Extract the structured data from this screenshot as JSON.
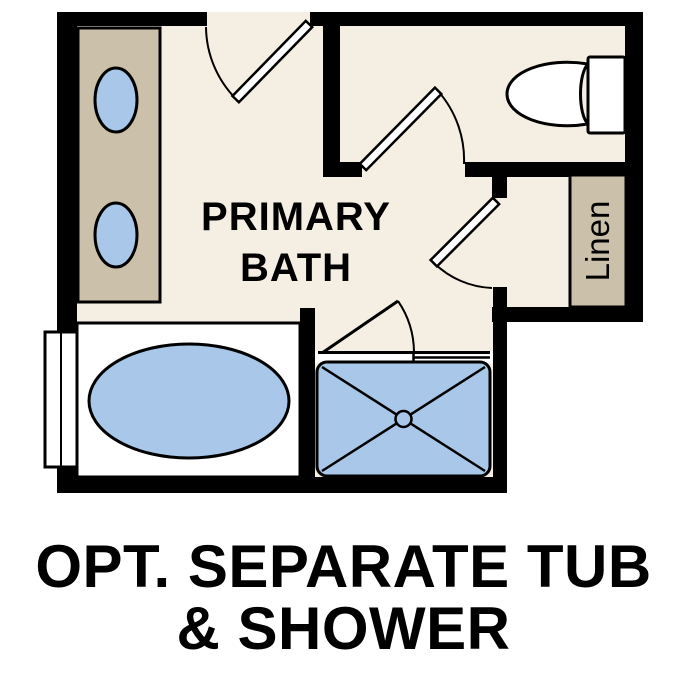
{
  "title": "Primary Bath optional layout floor plan",
  "colors": {
    "floor": "#f5eee3",
    "fixture_tan": "#cbc1ab",
    "fixture_blue": "#a9c8e9",
    "wall": "#000000",
    "text": "#000000",
    "background": "#ffffff"
  },
  "plan": {
    "room_label": {
      "line1": "PRIMARY",
      "line2": "BATH"
    },
    "linen_label": "Linen",
    "fixtures": [
      "double-sink-vanity",
      "toilet",
      "linen-closet",
      "soaking-tub",
      "shower",
      "window",
      "doors"
    ]
  },
  "caption": {
    "line1": "OPT. SEPARATE TUB",
    "line2": "& SHOWER"
  }
}
